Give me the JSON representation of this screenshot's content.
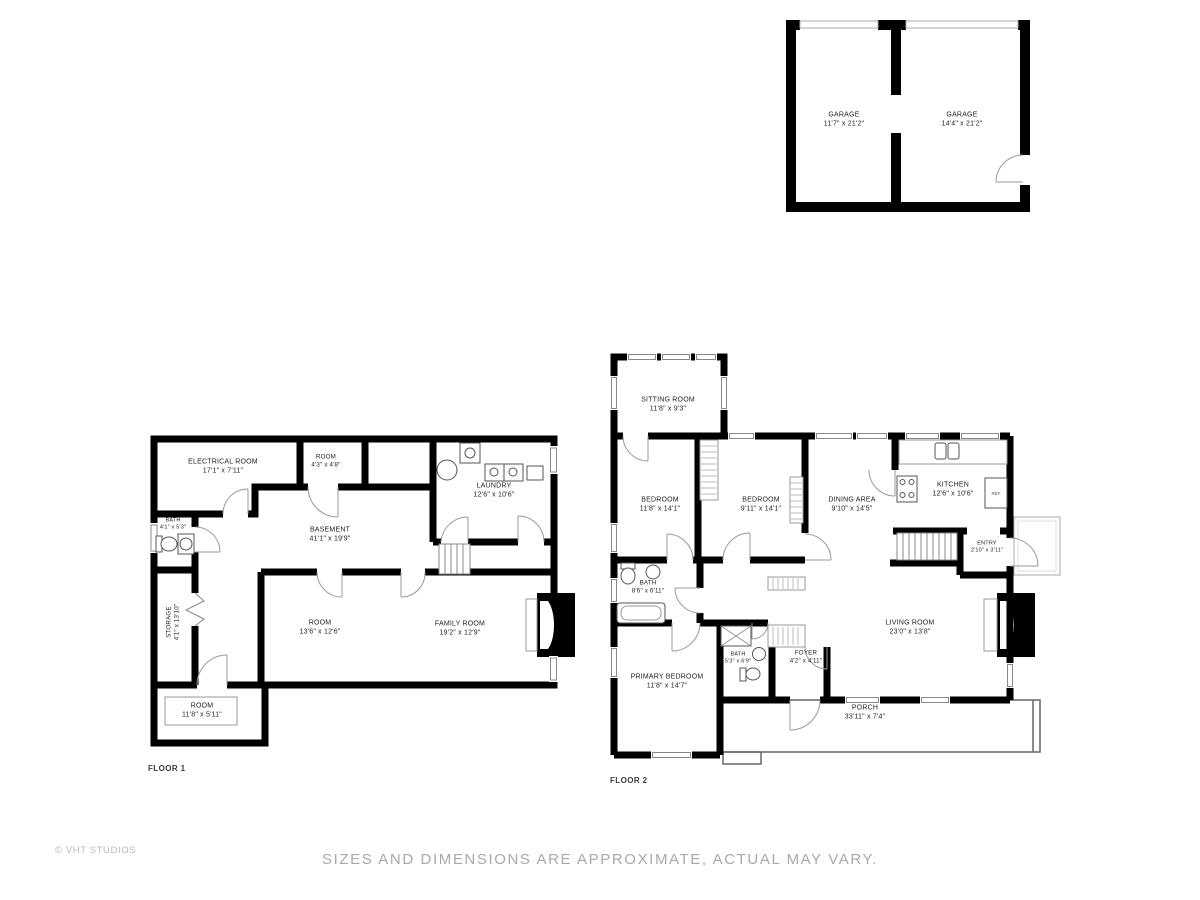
{
  "footer": {
    "disclaimer": "SIZES AND DIMENSIONS ARE APPROXIMATE, ACTUAL MAY VARY.",
    "watermark": "© VHT STUDIOS"
  },
  "garage_plan": {
    "rooms": [
      {
        "name": "GARAGE",
        "dims": "11'7\" x 21'2\""
      },
      {
        "name": "GARAGE",
        "dims": "14'4\" x 21'2\""
      }
    ]
  },
  "floor1": {
    "label": "FLOOR 1",
    "rooms": [
      {
        "name": "ELECTRICAL ROOM",
        "dims": "17'1\" x 7'11\""
      },
      {
        "name": "ROOM",
        "dims": "4'3\" x 4'8\""
      },
      {
        "name": "LAUNDRY",
        "dims": "12'6\" x 10'6\""
      },
      {
        "name": "BATH",
        "dims": "4'1\" x 5'3\""
      },
      {
        "name": "BASEMENT",
        "dims": "41'1\" x 19'9\""
      },
      {
        "name": "STORAGE",
        "dims": "4'1\" x 13'10\""
      },
      {
        "name": "ROOM",
        "dims": "13'6\" x 12'6\""
      },
      {
        "name": "FAMILY ROOM",
        "dims": "19'2\" x 12'9\""
      },
      {
        "name": "ROOM",
        "dims": "11'8\" x 5'11\""
      }
    ]
  },
  "floor2": {
    "label": "FLOOR 2",
    "appliances": {
      "ref": "REF"
    },
    "rooms": [
      {
        "name": "SITTING ROOM",
        "dims": "11'8\" x 9'3\""
      },
      {
        "name": "BEDROOM",
        "dims": "11'8\" x 14'1\""
      },
      {
        "name": "BEDROOM",
        "dims": "9'11\" x 14'1\""
      },
      {
        "name": "DINING AREA",
        "dims": "9'10\" x 14'5\""
      },
      {
        "name": "KITCHEN",
        "dims": "12'6\" x 10'6\""
      },
      {
        "name": "ENTRY",
        "dims": "2'10\" x 3'11\""
      },
      {
        "name": "BATH",
        "dims": "8'6\" x 6'11\""
      },
      {
        "name": "PRIMARY BEDROOM",
        "dims": "11'8\" x 14'7\""
      },
      {
        "name": "BATH",
        "dims": "5'3\" x 6'9\""
      },
      {
        "name": "FOYER",
        "dims": "4'2\" x 4'11\""
      },
      {
        "name": "LIVING ROOM",
        "dims": "23'0\" x 13'8\""
      },
      {
        "name": "PORCH",
        "dims": "33'11\" x 7'4\""
      }
    ]
  }
}
